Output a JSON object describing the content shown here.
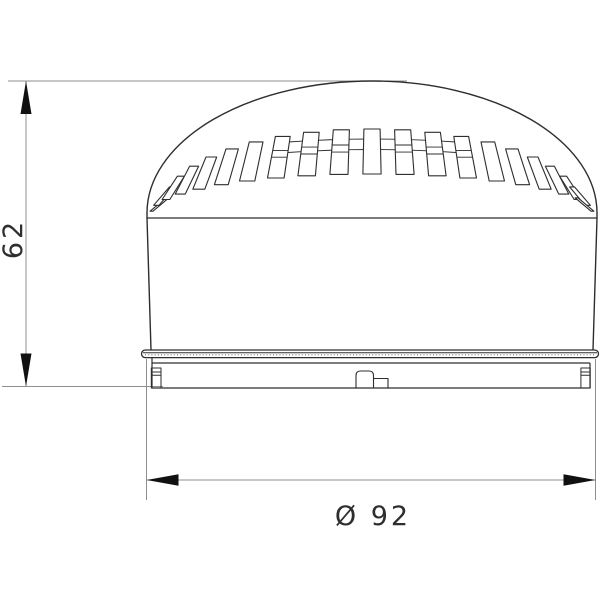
{
  "drawing": {
    "kind": "technical-dimension-drawing",
    "dimension_height": {
      "label": "62"
    },
    "dimension_diameter": {
      "label": "Ø 92"
    }
  },
  "colors": {
    "outline": "#2e2e2e",
    "detail": "#2e2e2e",
    "dimension_line": "#8f8f8f",
    "arrow": "#111111",
    "background": "#ffffff"
  }
}
